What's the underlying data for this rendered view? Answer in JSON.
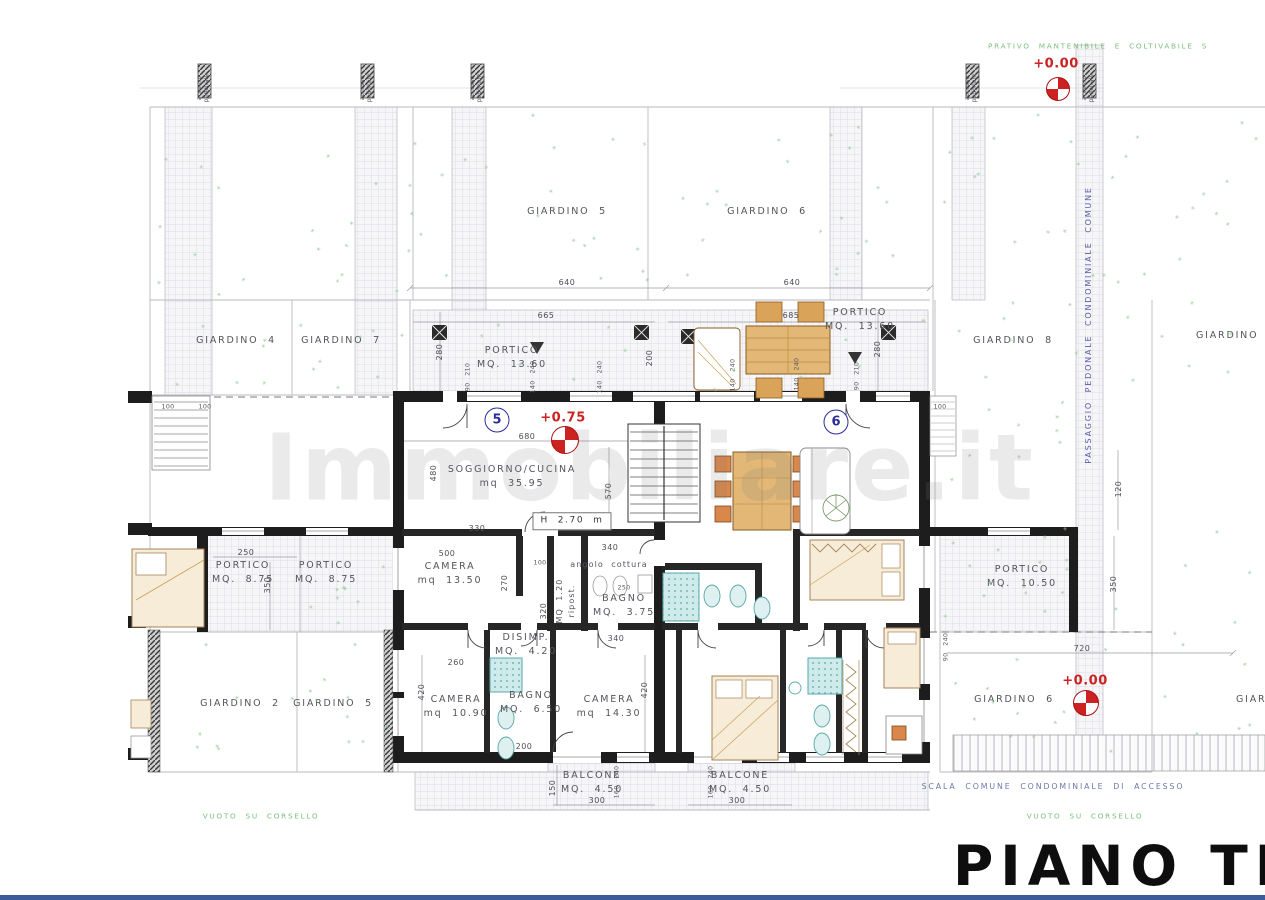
{
  "title": {
    "text": "PIANO TERRA"
  },
  "watermark": {
    "text": "Immobiliare.it"
  },
  "colors": {
    "elevation_red": "#cc2222",
    "unit_blue": "#2b2b9b",
    "vegetation_green": "#7bbf7b",
    "note_blue": "#6a79a8",
    "passaggio_blue": "#5c5cab",
    "wall_black": "#1d1d1d",
    "fixture_teal": "#58a8a8",
    "wood_tan": "#d9a45a",
    "bottom_bar_blue": "#3d5a99"
  },
  "units": [
    {
      "number": "5",
      "x": 497,
      "y": 420
    },
    {
      "number": "6",
      "x": 836,
      "y": 422
    }
  ],
  "markers": [
    {
      "name": "benchmark-top-right",
      "x": 1058,
      "y": 89,
      "r": 11
    },
    {
      "name": "benchmark-center",
      "x": 565,
      "y": 440,
      "r": 13
    },
    {
      "name": "benchmark-bottom-right",
      "x": 1086,
      "y": 703,
      "r": 12
    }
  ],
  "labels": [
    {
      "name": "note-grass-top",
      "cls": "green al",
      "text": "PRATIVO  MANTENIBILE  E  COLTIVABILE  S",
      "x": 988,
      "y": 47
    },
    {
      "name": "elevation-top",
      "cls": "elev",
      "text": "+0.00",
      "x": 1056,
      "y": 64
    },
    {
      "name": "garden-5-top-label",
      "cls": "room",
      "text": "GIARDINO  5",
      "x": 567,
      "y": 212
    },
    {
      "name": "garden-6-top-label",
      "cls": "room",
      "text": "GIARDINO  6",
      "x": 767,
      "y": 212
    },
    {
      "name": "dim-640-left",
      "cls": "dim",
      "text": "640",
      "x": 567,
      "y": 283
    },
    {
      "name": "dim-640-right",
      "cls": "dim",
      "text": "640",
      "x": 792,
      "y": 283
    },
    {
      "name": "garden-4-label",
      "cls": "room",
      "text": "GIARDINO  4",
      "x": 236,
      "y": 341
    },
    {
      "name": "garden-7-label",
      "cls": "room",
      "text": "GIARDINO  7",
      "x": 341,
      "y": 341
    },
    {
      "name": "garden-8-label",
      "cls": "room",
      "text": "GIARDINO  8",
      "x": 1013,
      "y": 341
    },
    {
      "name": "garden-right-cut-label",
      "cls": "room al",
      "text": "GIARDINO",
      "x": 1196,
      "y": 336
    },
    {
      "name": "portico-top-left-label",
      "cls": "room",
      "text": "PORTICO\nMQ.  13.60",
      "x": 512,
      "y": 358
    },
    {
      "name": "portico-top-right-label",
      "cls": "room",
      "text": "PORTICO\nMQ.  13.60",
      "x": 860,
      "y": 320
    },
    {
      "name": "dim-665",
      "cls": "dim",
      "text": "665",
      "x": 546,
      "y": 316
    },
    {
      "name": "dim-685",
      "cls": "dim",
      "text": "685",
      "x": 791,
      "y": 316
    },
    {
      "name": "dim-280-left",
      "cls": "dim rot",
      "text": "280",
      "x": 440,
      "y": 352
    },
    {
      "name": "dim-280-right",
      "cls": "dim rot",
      "text": "280",
      "x": 878,
      "y": 349
    },
    {
      "name": "dim-200-stair",
      "cls": "dim rot",
      "text": "200",
      "x": 650,
      "y": 358
    },
    {
      "name": "dim-90-210-left",
      "cls": "dims rot",
      "text": "90   210",
      "x": 468,
      "y": 377
    },
    {
      "name": "dim-140-240-a",
      "cls": "dims rot",
      "text": "140   240",
      "x": 533,
      "y": 377
    },
    {
      "name": "dim-140-240-b",
      "cls": "dims rot",
      "text": "140   240",
      "x": 600,
      "y": 377
    },
    {
      "name": "dim-140-240-c",
      "cls": "dims rot",
      "text": "140   240",
      "x": 733,
      "y": 375
    },
    {
      "name": "dim-140-240-d",
      "cls": "dims rot",
      "text": "140   240",
      "x": 797,
      "y": 374
    },
    {
      "name": "dim-90-210-right",
      "cls": "dims rot",
      "text": "90   210",
      "x": 857,
      "y": 376
    },
    {
      "name": "unit-5-elevation",
      "cls": "elev",
      "text": "+0.75",
      "x": 563,
      "y": 418
    },
    {
      "name": "dim-680",
      "cls": "dim",
      "text": "680",
      "x": 527,
      "y": 437
    },
    {
      "name": "soggiorno-cucina-label",
      "cls": "room",
      "text": "SOGGIORNO/CUCINA\nmq  35.95",
      "x": 512,
      "y": 477
    },
    {
      "name": "dim-480",
      "cls": "dim rot",
      "text": "480",
      "x": 434,
      "y": 473
    },
    {
      "name": "dim-570",
      "cls": "dim rot",
      "text": "570",
      "x": 609,
      "y": 491
    },
    {
      "name": "ceiling-height-box",
      "cls": "hbox",
      "text": "H  2.70  m",
      "x": 572,
      "y": 521
    },
    {
      "name": "dim-330",
      "cls": "dim",
      "text": "330",
      "x": 477,
      "y": 529
    },
    {
      "name": "dim-340-top",
      "cls": "dim",
      "text": "340",
      "x": 610,
      "y": 548
    },
    {
      "name": "angolo-cottura-label",
      "cls": "roomsm",
      "text": "angolo  cottura",
      "x": 609,
      "y": 565
    },
    {
      "name": "dim-500",
      "cls": "dim",
      "text": "500",
      "x": 447,
      "y": 554
    },
    {
      "name": "dim-100-corridor",
      "cls": "dims",
      "text": "100",
      "x": 540,
      "y": 563
    },
    {
      "name": "camera-13-50-label",
      "cls": "room",
      "text": "CAMERA\nmq  13.50",
      "x": 450,
      "y": 574
    },
    {
      "name": "ripostiglio-label",
      "cls": "roomsm rot",
      "text": "MQ  1.20\nripost.",
      "x": 566,
      "y": 601
    },
    {
      "name": "bagno-3-75-label",
      "cls": "room",
      "text": "BAGNO\nMQ.  3.75",
      "x": 624,
      "y": 606
    },
    {
      "name": "dim-250-bagno",
      "cls": "dims",
      "text": "250",
      "x": 624,
      "y": 588
    },
    {
      "name": "dim-270",
      "cls": "dim rot",
      "text": "270",
      "x": 505,
      "y": 583
    },
    {
      "name": "dim-320",
      "cls": "dim rot",
      "text": "320",
      "x": 544,
      "y": 611
    },
    {
      "name": "disimpegno-label",
      "cls": "room",
      "text": "DISIMP.\nMQ.  4.20",
      "x": 526,
      "y": 645
    },
    {
      "name": "dim-340-bagno",
      "cls": "dim",
      "text": "340",
      "x": 616,
      "y": 639
    },
    {
      "name": "dim-260",
      "cls": "dim",
      "text": "260",
      "x": 456,
      "y": 663
    },
    {
      "name": "dim-420-left",
      "cls": "dim rot",
      "text": "420",
      "x": 422,
      "y": 692
    },
    {
      "name": "dim-420-right",
      "cls": "dim rot",
      "text": "420",
      "x": 645,
      "y": 690
    },
    {
      "name": "camera-10-90-label",
      "cls": "room",
      "text": "CAMERA\nmq  10.90",
      "x": 456,
      "y": 707
    },
    {
      "name": "bagno-6-50-label",
      "cls": "room",
      "text": "BAGNO\nMQ.  6.50",
      "x": 531,
      "y": 703
    },
    {
      "name": "camera-14-30-label",
      "cls": "room",
      "text": "CAMERA\nmq  14.30",
      "x": 609,
      "y": 707
    },
    {
      "name": "dim-200-bagno",
      "cls": "dim",
      "text": "200",
      "x": 524,
      "y": 747
    },
    {
      "name": "portico-8-75-a-label",
      "cls": "room",
      "text": "PORTICO\nMQ.  8.75",
      "x": 243,
      "y": 573
    },
    {
      "name": "portico-8-75-b-label",
      "cls": "room",
      "text": "PORTICO\nMQ.  8.75",
      "x": 326,
      "y": 573
    },
    {
      "name": "dim-250-portico",
      "cls": "dim",
      "text": "250",
      "x": 246,
      "y": 553
    },
    {
      "name": "dim-350-portico",
      "cls": "dim rot",
      "text": "350",
      "x": 268,
      "y": 585
    },
    {
      "name": "dim-100-a",
      "cls": "dims",
      "text": "100",
      "x": 168,
      "y": 407
    },
    {
      "name": "dim-100-b",
      "cls": "dims",
      "text": "100",
      "x": 205,
      "y": 407
    },
    {
      "name": "dim-100-c",
      "cls": "dims",
      "text": "100",
      "x": 940,
      "y": 407
    },
    {
      "name": "garden-2-label",
      "cls": "room",
      "text": "GIARDINO  2",
      "x": 240,
      "y": 704
    },
    {
      "name": "garden-5-bottom-label",
      "cls": "room",
      "text": "GIARDINO  5",
      "x": 333,
      "y": 704
    },
    {
      "name": "portico-10-50-label",
      "cls": "room",
      "text": "PORTICO\nMQ.  10.50",
      "x": 1022,
      "y": 577
    },
    {
      "name": "dim-350-right",
      "cls": "dim rot",
      "text": "350",
      "x": 1114,
      "y": 584
    },
    {
      "name": "dim-120",
      "cls": "dim rot",
      "text": "120",
      "x": 1119,
      "y": 489
    },
    {
      "name": "dim-720",
      "cls": "dim",
      "text": "720",
      "x": 1082,
      "y": 649
    },
    {
      "name": "dim-90-240-right",
      "cls": "dims rot",
      "text": "90   240",
      "x": 946,
      "y": 647
    },
    {
      "name": "garden-6-bottom-label",
      "cls": "room",
      "text": "GIARDINO  6",
      "x": 1014,
      "y": 700
    },
    {
      "name": "elevation-bottom",
      "cls": "elev",
      "text": "+0.00",
      "x": 1085,
      "y": 681
    },
    {
      "name": "garden-bottom-cut-label",
      "cls": "room al",
      "text": "GIARDINO",
      "x": 1236,
      "y": 700
    },
    {
      "name": "balcone-left-label",
      "cls": "room",
      "text": "BALCONE\nMQ.  4.50",
      "x": 592,
      "y": 783
    },
    {
      "name": "balcone-right-label",
      "cls": "room",
      "text": "BALCONE\nMQ.  4.50",
      "x": 740,
      "y": 783
    },
    {
      "name": "dim-150-balcone",
      "cls": "dim rot",
      "text": "150",
      "x": 553,
      "y": 788
    },
    {
      "name": "dim-300-left",
      "cls": "dim",
      "text": "300",
      "x": 597,
      "y": 801
    },
    {
      "name": "dim-300-right",
      "cls": "dim",
      "text": "300",
      "x": 737,
      "y": 801
    },
    {
      "name": "dim-160-240-left",
      "cls": "dims rot",
      "text": "160   240",
      "x": 617,
      "y": 782
    },
    {
      "name": "dim-160-240-right",
      "cls": "dims rot",
      "text": "160   240",
      "x": 711,
      "y": 782
    },
    {
      "name": "scala-comune-note",
      "cls": "note",
      "text": "SCALA  COMUNE  CONDOMINIALE  DI  ACCESSO",
      "x": 1053,
      "y": 787
    },
    {
      "name": "vuoto-corsello-left",
      "cls": "green",
      "text": "VUOTO  SU  CORSELLO",
      "x": 261,
      "y": 817
    },
    {
      "name": "vuoto-corsello-right",
      "cls": "green",
      "text": "VUOTO  SU  CORSELLO",
      "x": 1085,
      "y": 817
    },
    {
      "name": "passaggio-pedonale-note",
      "cls": "vblue rot",
      "text": "PASSAGGIO  PEDONALE  CONDOMINIALE  COMUNE",
      "x": 1089,
      "y": 325
    },
    {
      "name": "accesso-pedonale-1",
      "cls": "acc rot",
      "text": "accesso\npedonale",
      "x": 204,
      "y": 88
    },
    {
      "name": "accesso-pedonale-2",
      "cls": "acc rot",
      "text": "accesso\npedonale",
      "x": 367,
      "y": 88
    },
    {
      "name": "accesso-pedonale-3",
      "cls": "acc rot",
      "text": "accesso\npedonale",
      "x": 477,
      "y": 88
    },
    {
      "name": "accesso-pedonale-4",
      "cls": "acc rot",
      "text": "accesso\npedonale",
      "x": 972,
      "y": 88
    },
    {
      "name": "accesso-pedonale-5",
      "cls": "acc rot",
      "text": "accesso\npedonale",
      "x": 1089,
      "y": 88
    }
  ]
}
